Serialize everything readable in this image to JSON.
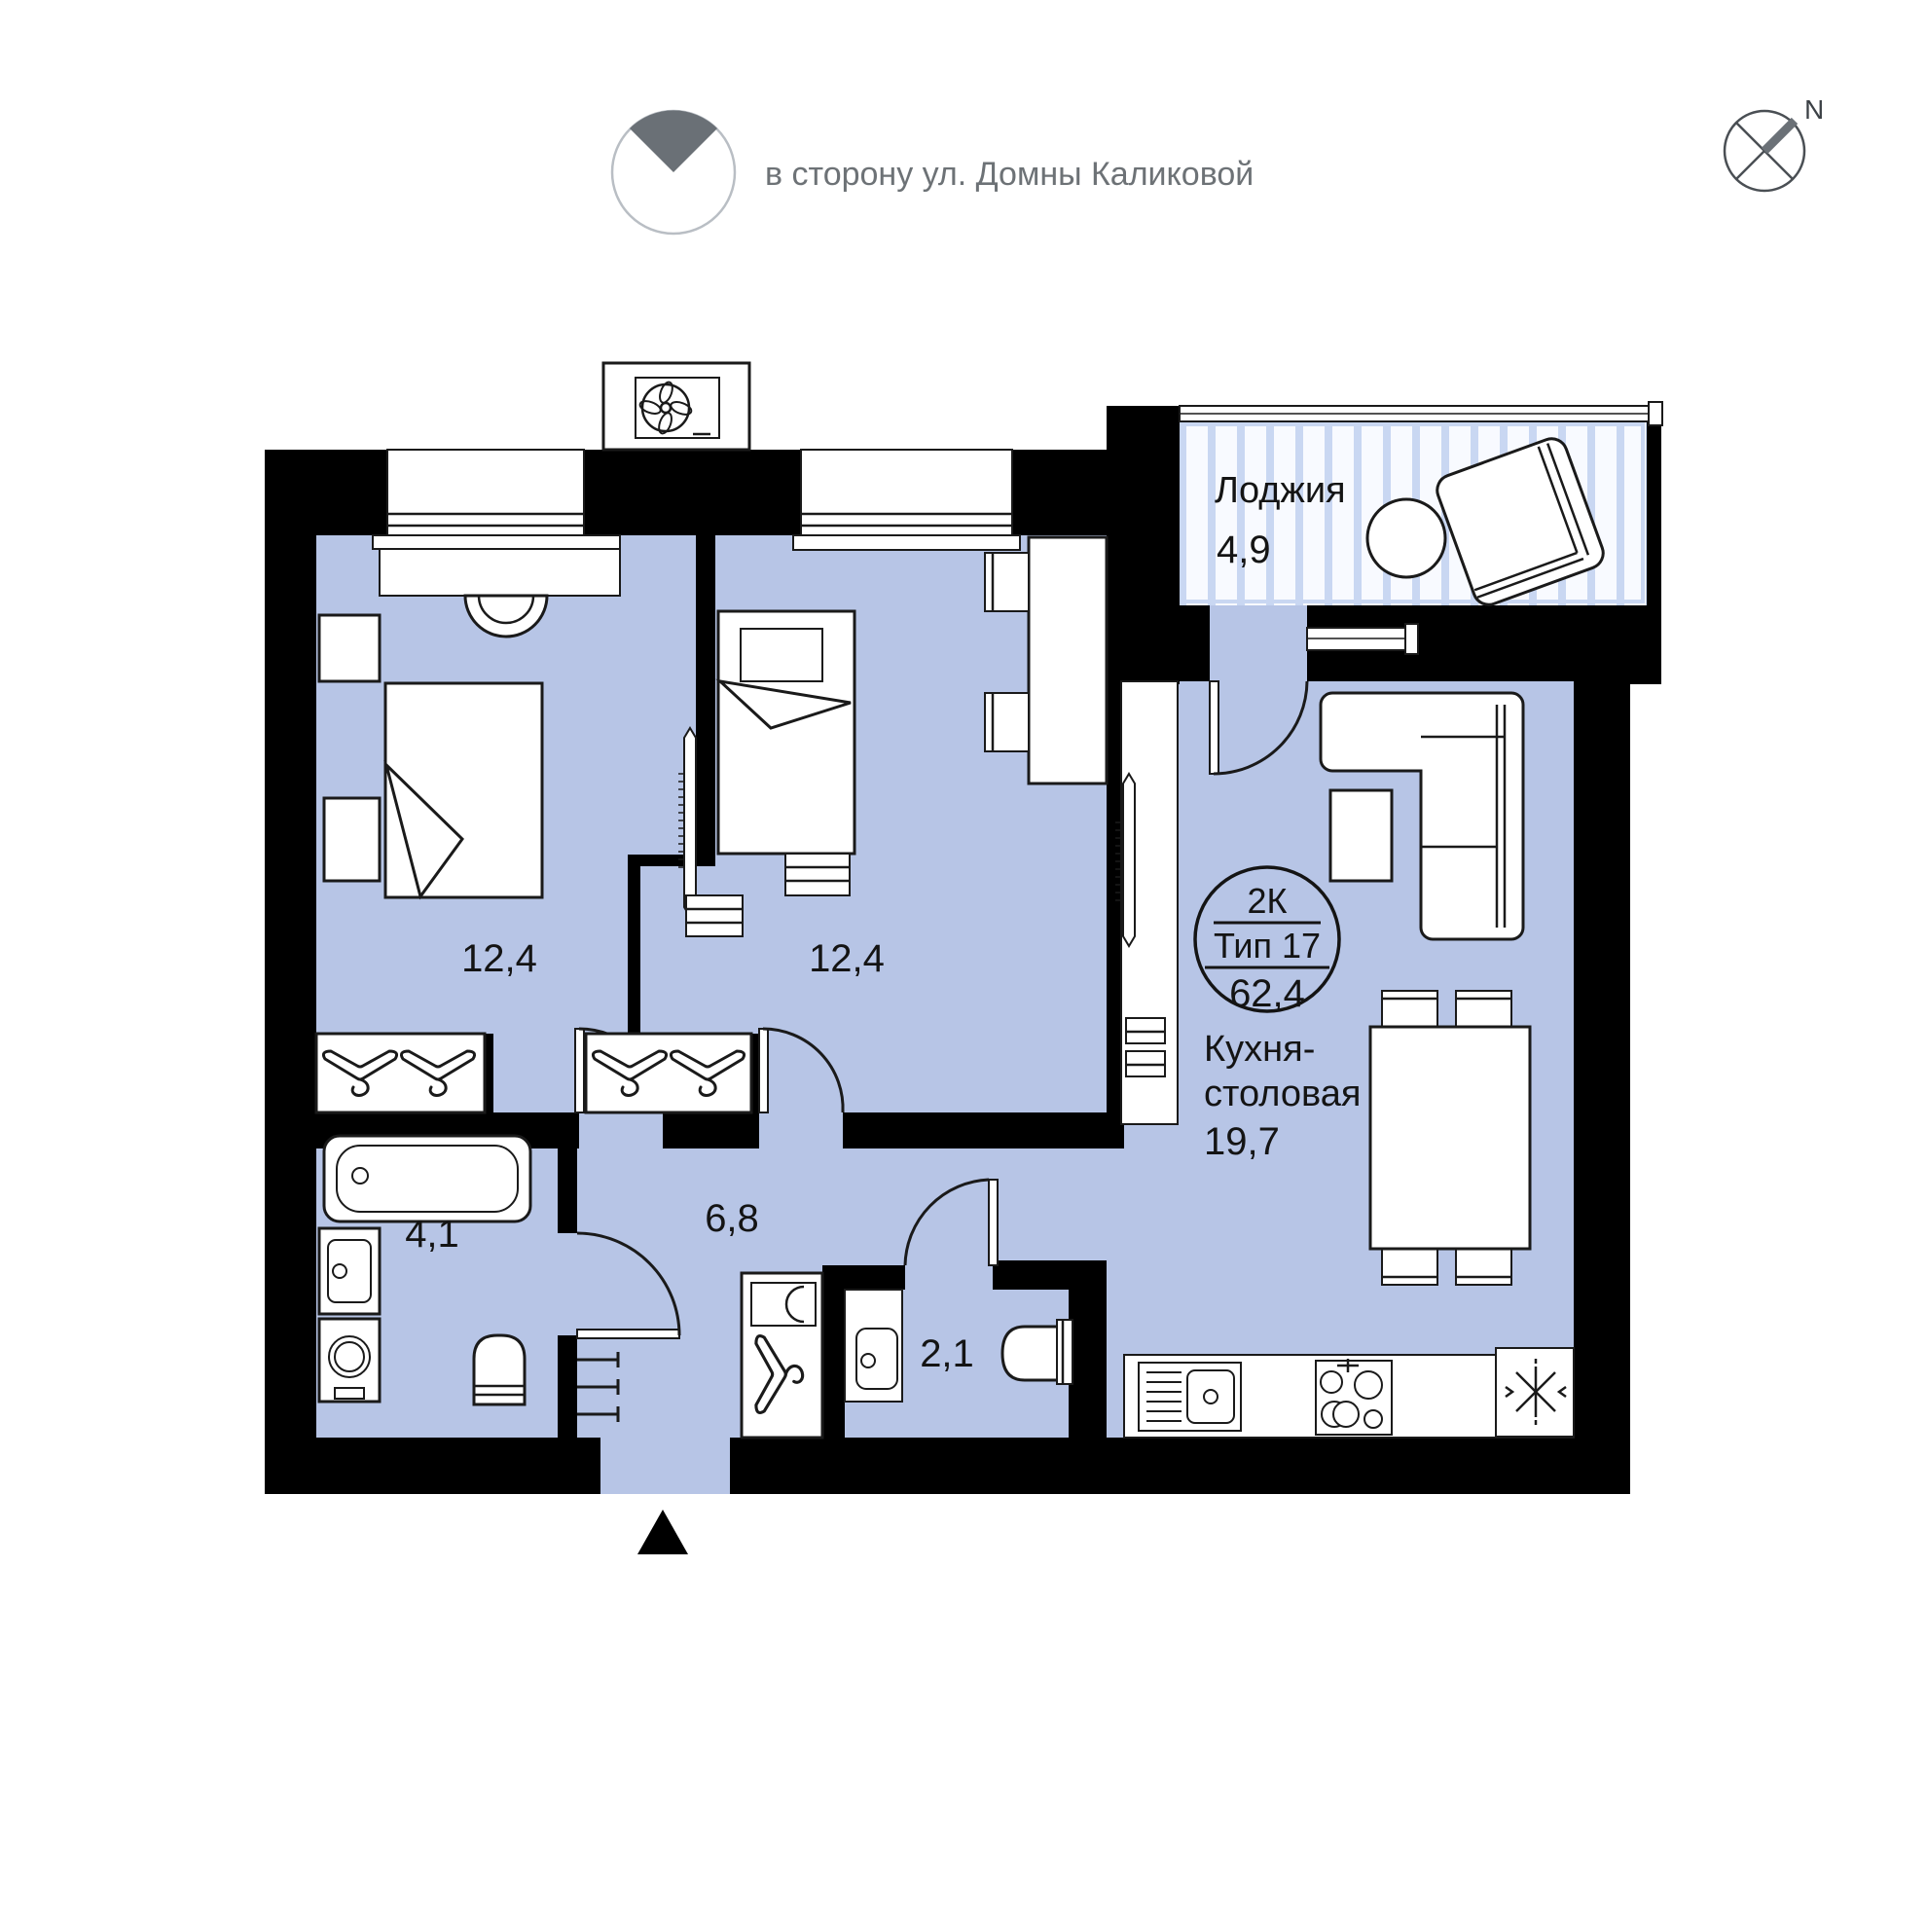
{
  "header": {
    "direction_note": "в сторону ул. Домны Каликовой",
    "compass": {
      "north_label": "N"
    }
  },
  "unit_badge": {
    "rooms": "2К",
    "type": "Тип 17",
    "total_area": "62,4"
  },
  "rooms": {
    "loggia": {
      "name": "Лоджия",
      "area": "4,9"
    },
    "bedroom_1": {
      "area": "12,4"
    },
    "bedroom_2": {
      "area": "12,4"
    },
    "hallway": {
      "area": "6,8"
    },
    "bathroom": {
      "area": "4,1"
    },
    "wc": {
      "area": "2,1"
    },
    "kitchen_dining": {
      "name_line_1": "Кухня-",
      "name_line_2": "столовая",
      "area": "19,7"
    }
  },
  "colors": {
    "floor": "#b7c5e6",
    "wall": "#000000",
    "loggia_stripe": "#c9d7f2",
    "muted_text": "#6d7276"
  }
}
